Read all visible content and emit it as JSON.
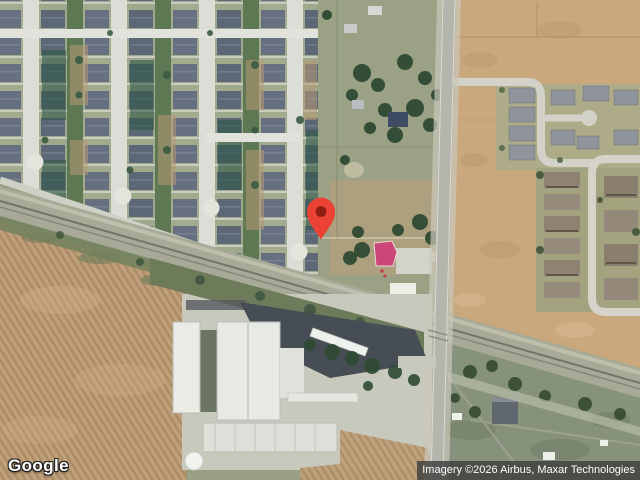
{
  "map": {
    "marker": {
      "name": "location-pin",
      "color": "#EA4335",
      "dot_color": "#8E1D13"
    },
    "logo": {
      "text": "Google",
      "color": "#FFFFFF"
    },
    "attribution": {
      "text": "Imagery ©2026 Airbus, Maxar Technologies",
      "text_color": "#FFFFFF",
      "background": "rgba(58,58,58,0.78)"
    }
  }
}
